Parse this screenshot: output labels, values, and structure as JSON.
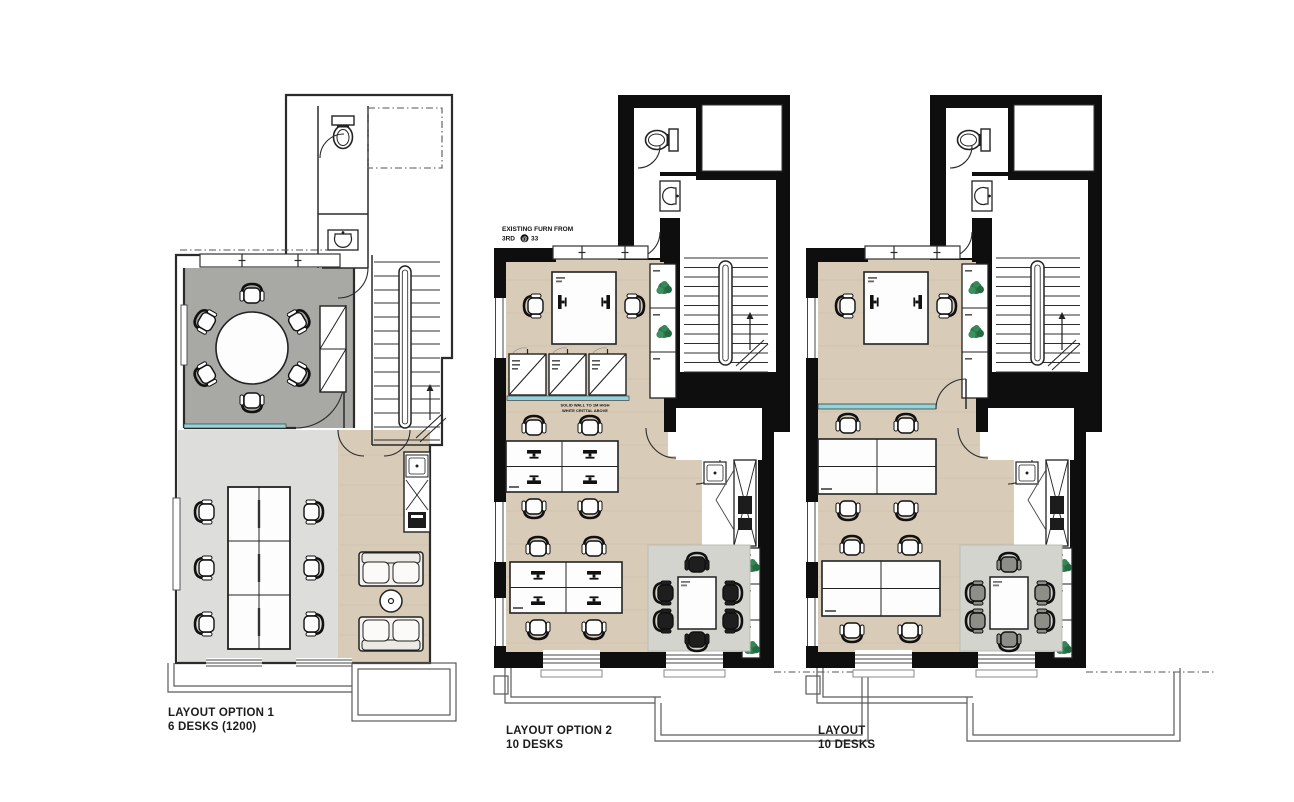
{
  "plans": [
    {
      "name": "plan-option-1",
      "label_line1": "LAYOUT OPTION 1",
      "label_line2": "6 DESKS (1200)"
    },
    {
      "name": "plan-option-2",
      "label_line1": "LAYOUT OPTION 2",
      "label_line2": "10 DESKS",
      "annotation_line1": "EXISTING FURN FROM",
      "annotation_line2_prefix": "3RD",
      "annotation_line2_symbol": "@",
      "annotation_line2_suffix": "33",
      "wall_note_line1": "SOLID WALL TO 1M HIGH",
      "wall_note_line2": "WHITE CRITTAL ABOVE"
    },
    {
      "name": "plan-option-3",
      "label_line1": "LAYOUT",
      "label_line2": "10 DESKS"
    }
  ],
  "colors": {
    "wall_black": "#0e0e0e",
    "line_dark": "#2b2b2b",
    "meeting_room": "#a8a8a4",
    "office_floor": "#dddddb",
    "wood_floor": "#d8ccb9",
    "glazing_teal": "#93d4da",
    "rug": "#d4d4ce",
    "chair_dark": "#1e1e1e",
    "chair_gray": "#8e8e89",
    "plant_green": "#2d7c4d",
    "white": "#ffffff"
  }
}
